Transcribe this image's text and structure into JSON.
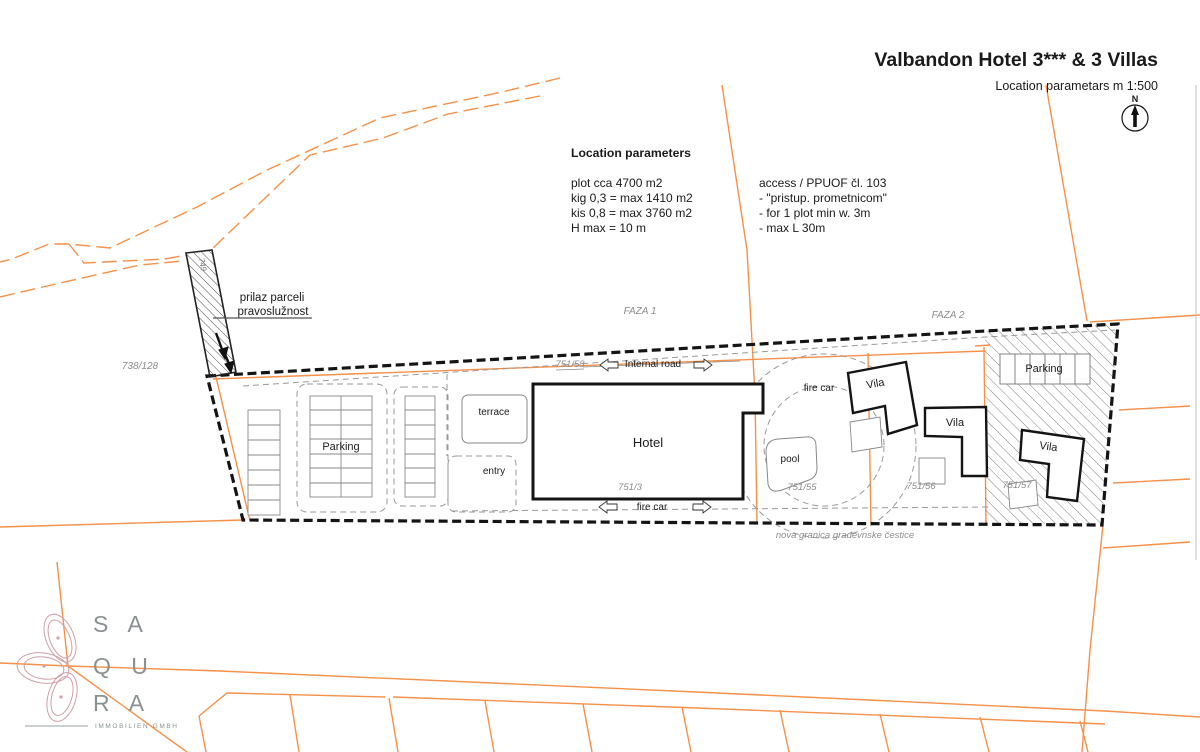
{
  "title": {
    "main": "Valbandon Hotel 3*** & 3 Villas",
    "subtitle": "Location parametars m 1:500",
    "compass_n": "N"
  },
  "parameters": {
    "heading": "Location parameters",
    "line1": "plot cca 4700 m2",
    "line2": "kig 0,3 = max 1410 m2",
    "line3": "kis 0,8 = max 3760 m2",
    "line4": "H max = 10 m"
  },
  "access": {
    "line1": "access / PPUOF čl. 103",
    "line2": "- \"pristup. prometnicom\"",
    "line3": "- for 1 plot min w. 3m",
    "line4": "- max L 30m"
  },
  "labels": {
    "prilaz1": "prilaz parceli",
    "prilaz2": "pravoslužnost",
    "faza1": "FAZA 1",
    "faza2": "FAZA 2",
    "internal_road": "Internal road",
    "fire_car_top": "fire car",
    "fire_car_bottom": "fire car",
    "hotel": "Hotel",
    "terrace": "terrace",
    "entry": "entry",
    "pool": "pool",
    "parking_west": "Parking",
    "parking_east": "Parking",
    "vila_1": "Vila",
    "vila_2": "Vila",
    "vila_3": "Vila",
    "boundary_note": "nova granica građevnske čestice"
  },
  "parcels": {
    "p738_128": "738/128",
    "p751_58": "751/58",
    "p751_3": "751/3",
    "p751_55": "751/55",
    "p751_56": "751/56",
    "p751_57": "751/57",
    "access_strip": "749"
  },
  "logo": {
    "row1": "S A",
    "row2": "Q U",
    "row3": "R A",
    "tagline": "IMMOBILIEN GMBH"
  },
  "colors": {
    "orange": "#f79048",
    "boundary_black": "#141414",
    "gray_line": "#999999",
    "gray_text": "#8c8c8c",
    "logo_pink": "#cf9fa8",
    "logo_gray": "#8b9192"
  }
}
